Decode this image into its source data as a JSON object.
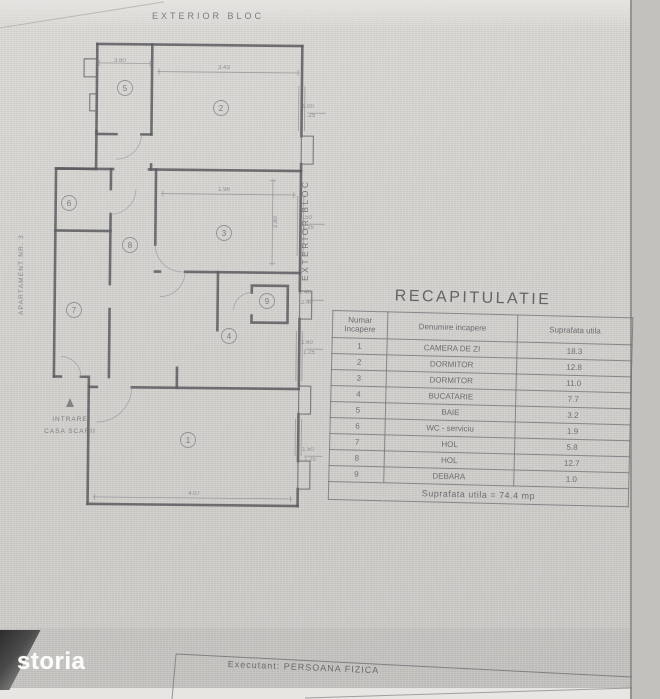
{
  "watermark": {
    "text": "storia"
  },
  "footer_box": {
    "text": "Executant: PERSOANA FIZICA"
  },
  "plan": {
    "label_top": "EXTERIOR BLOC",
    "label_right": "EXTERIOR BLOC",
    "label_left": "APARTAMENT NR. 3",
    "entrance": {
      "line1": "INTRARE",
      "line2": "CASA SCARII"
    },
    "rooms": [
      {
        "n": "1",
        "x": 188,
        "y": 440
      },
      {
        "n": "2",
        "x": 221,
        "y": 108
      },
      {
        "n": "3",
        "x": 224,
        "y": 233
      },
      {
        "n": "4",
        "x": 229,
        "y": 336
      },
      {
        "n": "5",
        "x": 125,
        "y": 88
      },
      {
        "n": "6",
        "x": 69,
        "y": 203
      },
      {
        "n": "7",
        "x": 74,
        "y": 310
      },
      {
        "n": "8",
        "x": 130,
        "y": 245
      },
      {
        "n": "9",
        "x": 267,
        "y": 301
      }
    ],
    "dimensions": [
      {
        "t": "3.60",
        "x": 120,
        "y": 62
      },
      {
        "t": "3.43",
        "x": 224,
        "y": 69
      },
      {
        "t": "1.96",
        "x": 224,
        "y": 191
      },
      {
        "t": "2.80",
        "x": 277,
        "y": 222,
        "rot": -90
      },
      {
        "t": "4.07",
        "x": 194,
        "y": 495
      },
      {
        "t": "1.00",
        "x": 308,
        "y": 108
      },
      {
        "t": ".25",
        "x": 311,
        "y": 117
      },
      {
        "t": "1.50",
        "x": 306,
        "y": 219
      },
      {
        "t": "1.25",
        "x": 308,
        "y": 229
      },
      {
        "t": "2.40",
        "x": 305,
        "y": 294
      },
      {
        "t": "2.40",
        "x": 307,
        "y": 304
      },
      {
        "t": "1.60",
        "x": 307,
        "y": 344
      },
      {
        "t": "1.25",
        "x": 309,
        "y": 354
      },
      {
        "t": "1.50",
        "x": 308,
        "y": 451
      },
      {
        "t": "1.25",
        "x": 310,
        "y": 461
      }
    ]
  },
  "table": {
    "title": "RECAPITULATIE",
    "col1_header_line1": "Numar",
    "col1_header_line2": "Incapere",
    "col2_header": "Denumire incapere",
    "col3_header": "Suprafata utila",
    "rows": [
      {
        "num": "1",
        "name": "CAMERA DE ZI",
        "area": "18.3"
      },
      {
        "num": "2",
        "name": "DORMITOR",
        "area": "12.8"
      },
      {
        "num": "3",
        "name": "DORMITOR",
        "area": "11.0"
      },
      {
        "num": "4",
        "name": "BUCATARIE",
        "area": "7.7"
      },
      {
        "num": "5",
        "name": "BAIE",
        "area": "3.2"
      },
      {
        "num": "6",
        "name": "WC - serviciu",
        "area": "1.9"
      },
      {
        "num": "7",
        "name": "HOL",
        "area": "5.8"
      },
      {
        "num": "8",
        "name": "HOL",
        "area": "12.7"
      },
      {
        "num": "9",
        "name": "DEBARA",
        "area": "1.0"
      }
    ],
    "footer": "Suprafata utila = 74.4 mp"
  }
}
